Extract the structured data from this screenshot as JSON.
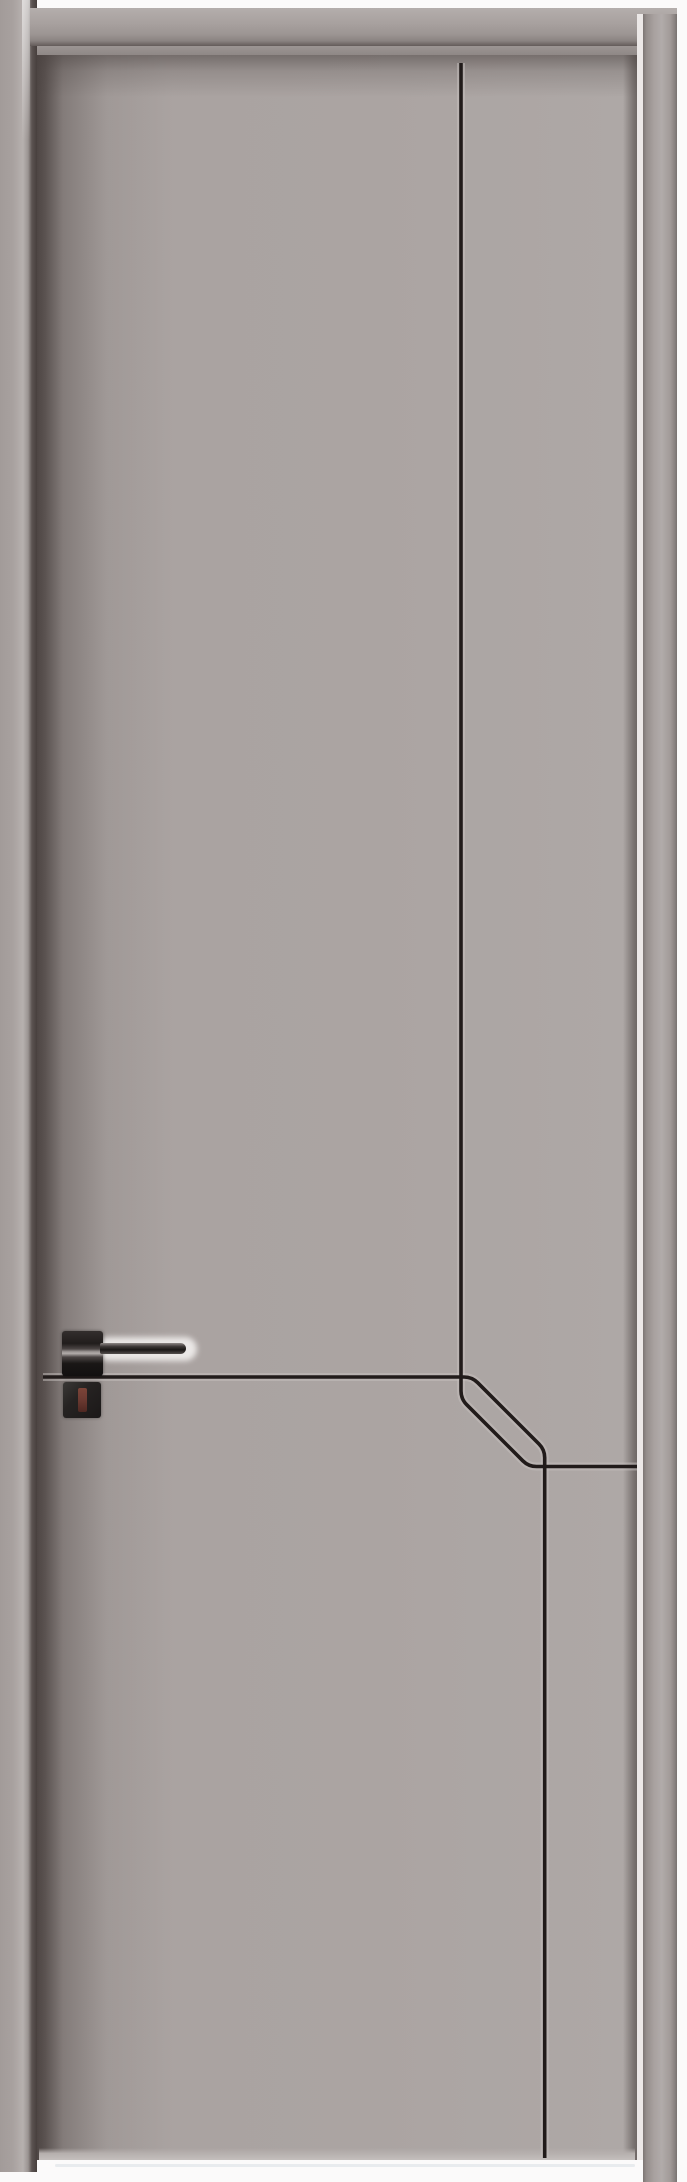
{
  "scene": {
    "alt": "Product photo of a modern minimalist grey interior door in a matching grey frame, decorated with thin black routed trim lines that run vertically, turn diagonally and cross near the lower third, fitted with a black square-rosette lever handle and a separate lock escutcheon with a dark red thumbturn",
    "subject": "grey minimalist interior door",
    "style": "flush door with routed black accent grooves"
  },
  "colors": {
    "floor_white": "#fbfafa",
    "frame": "#a8a19f",
    "door_face": "#aba4a2",
    "door_shadow": "#4e4644",
    "reveal_gap": "#ece8e7",
    "trim_line": "#211b1a",
    "trim_bevel": "#c6c0be",
    "handle_black": "#1a1716",
    "thumbturn_red": "#6d3b32"
  },
  "parts": {
    "frame_head": "door frame head casing",
    "jamb_left": "left frame jamb",
    "jamb_right": "right frame jamb",
    "reveal_gap": "light reveal gap between door and right jamb",
    "door_panel": "grey flush door slab",
    "trim_path_vertical": "black groove: vertical line turning 45° into lower-right horizontal",
    "trim_path_horizontal": "black groove: horizontal line turning 45° into lower vertical",
    "handle": "black lever door handle on square rosette",
    "lock": "black lock escutcheon with dark red thumbturn",
    "floor": "white floor with faint reflection line"
  }
}
